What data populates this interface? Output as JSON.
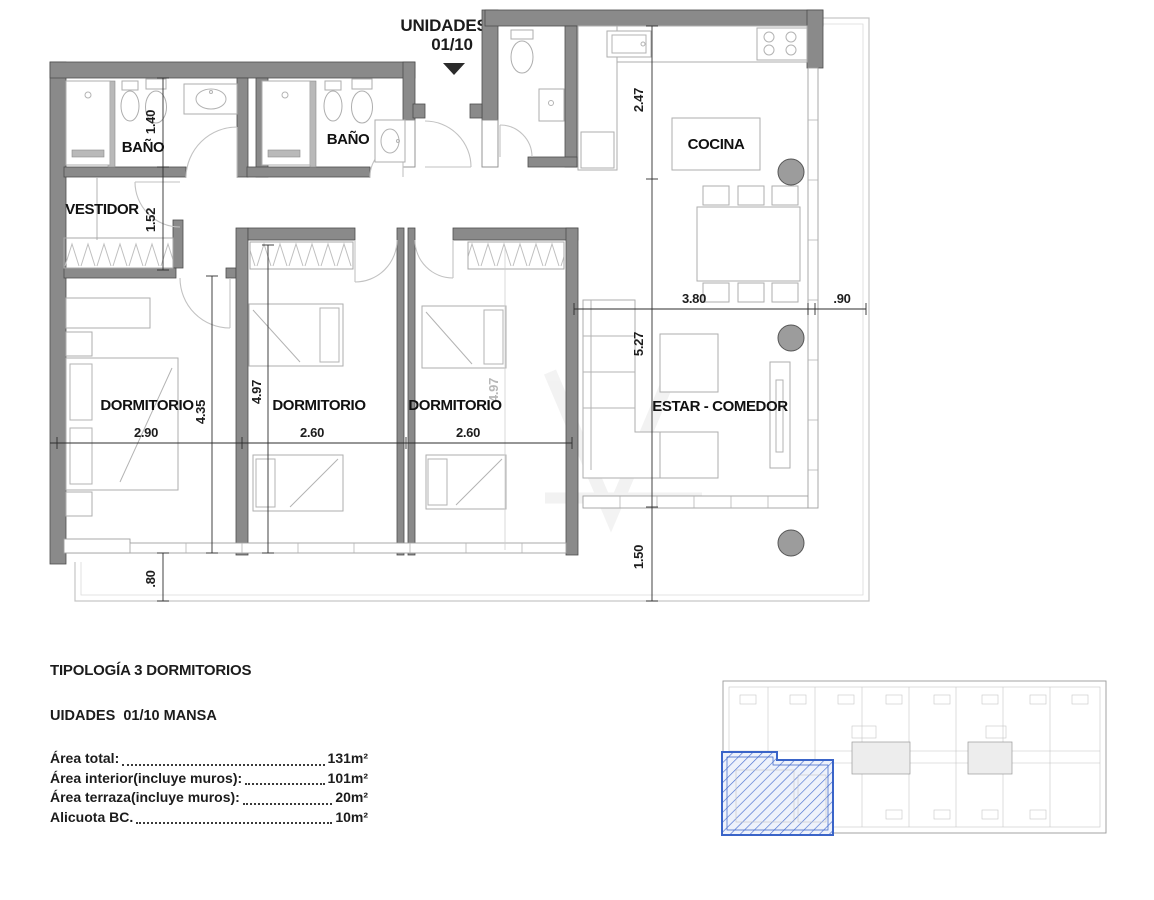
{
  "title": {
    "line1": "UNIDADES",
    "line2": "01/10"
  },
  "plan": {
    "rooms": [
      {
        "label": "BAÑO"
      },
      {
        "label": "BAÑO"
      },
      {
        "label": "VESTIDOR"
      },
      {
        "label": "COCINA"
      },
      {
        "label": "DORMITORIO"
      },
      {
        "label": "DORMITORIO"
      },
      {
        "label": "DORMITORIO"
      },
      {
        "label": "ESTAR - COMEDOR"
      }
    ],
    "dimensions": {
      "bano_height": "1.40",
      "vestidor_height": "1.52",
      "dorm1_height": "4.35",
      "dorm2_height": "4.97",
      "dorm3_height": "4.97",
      "dorm1_width": "2.90",
      "dorm2_width": "2.60",
      "dorm3_width": "2.60",
      "cocina_height": "2.47",
      "cocina_width": "3.80",
      "terrace_width": ".90",
      "estar_height": "5.27",
      "terrace_depth": "1.50",
      "balcony_depth": ".80"
    }
  },
  "info": {
    "heading": "TIPOLOGÍA 3 DORMITORIOS",
    "subheading": "UIDADES  01/10 MANSA",
    "rows": [
      {
        "label": "Área total:",
        "value": "131m²"
      },
      {
        "label": "Área interior(incluye muros):",
        "value": "101m²"
      },
      {
        "label": "Área terraza(incluye muros):",
        "value": "20m²"
      },
      {
        "label": "Alicuota BC.",
        "value": "10m²"
      }
    ]
  },
  "colors": {
    "wall": "#8a8a8a",
    "wall_stroke": "#4d4d4d",
    "column": "#9c9c9c",
    "highlight": "#3a64c8"
  }
}
